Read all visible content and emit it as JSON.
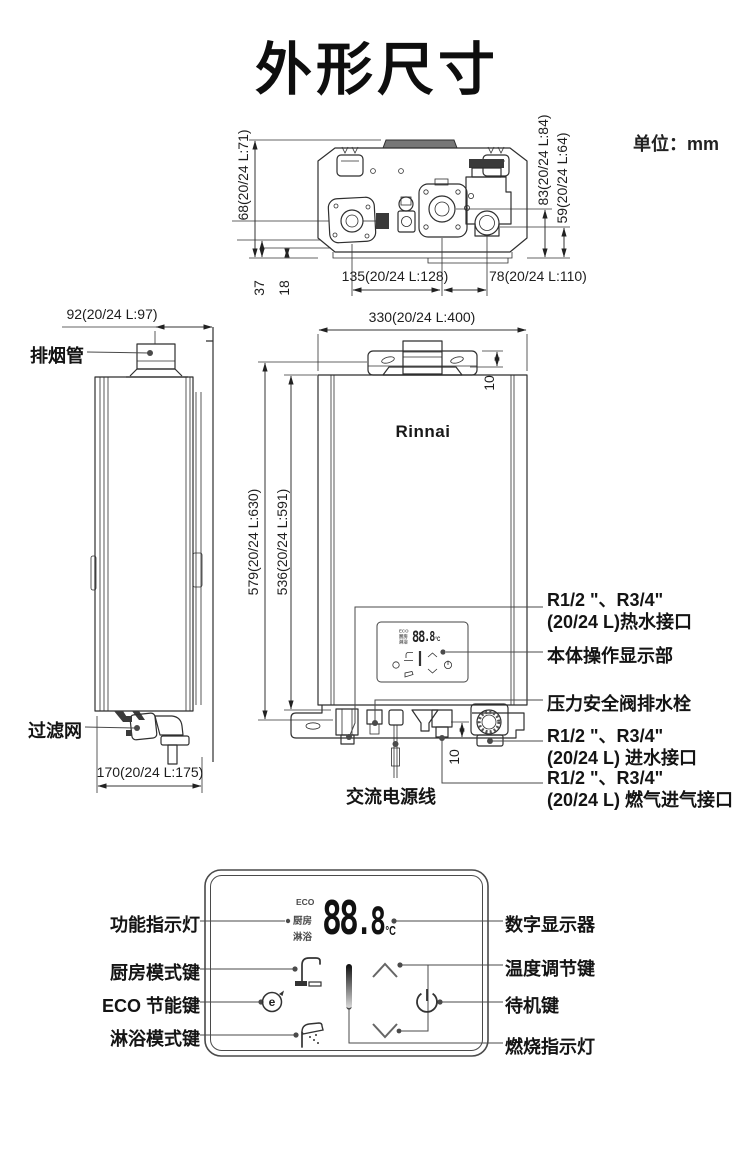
{
  "page": {
    "title": "外形尺寸",
    "unit_note": "单位：mm",
    "brand": "Rinnai"
  },
  "top_view": {
    "dim_left_height": "68(20/24 L:71)",
    "dim_right_height_a": "83(20/24 L:84)",
    "dim_right_height_b": "59(20/24 L:64)",
    "dim_bottom_left": "135(20/24 L:128)",
    "dim_bottom_right": "78(20/24 L:110)",
    "dim_small_a": "37",
    "dim_small_b": "18"
  },
  "side_view": {
    "dim_flue_offset": "92(20/24 L:97)",
    "dim_depth": "170(20/24 L:175)",
    "label_flue": "排烟管",
    "label_filter": "过滤网"
  },
  "front_view": {
    "dim_width": "330(20/24 L:400)",
    "dim_height_total": "579(20/24 L:630)",
    "dim_height_body": "536(20/24 L:591)",
    "dim_bracket_offset": "10",
    "dim_bottom_offset": "10"
  },
  "callouts": {
    "hot_water_1": "R1/2 \"、R3/4\"",
    "hot_water_2": "(20/24 L)热水接口",
    "operation_panel": "本体操作显示部",
    "relief_valve": "压力安全阀排水栓",
    "water_inlet_1": "R1/2 \"、R3/4\"",
    "water_inlet_2": "(20/24 L) 进水接口",
    "gas_inlet_1": "R1/2 \"、R3/4\"",
    "gas_inlet_2": "(20/24 L) 燃气进气接口",
    "power_cord": "交流电源线"
  },
  "control_panel": {
    "indicators": [
      "ECO",
      "厨房",
      "淋浴"
    ],
    "display_main": "88",
    "display_decimal": ".8",
    "display_unit": "°C",
    "eco_icon_glyph": "e",
    "labels_left": [
      "功能指示灯",
      "厨房模式键",
      "ECO 节能键",
      "淋浴模式键"
    ],
    "labels_right": [
      "数字显示器",
      "温度调节键",
      "待机键",
      "燃烧指示灯"
    ]
  },
  "colors": {
    "line": "#2f2f2f",
    "text": "#1a1a1a"
  }
}
